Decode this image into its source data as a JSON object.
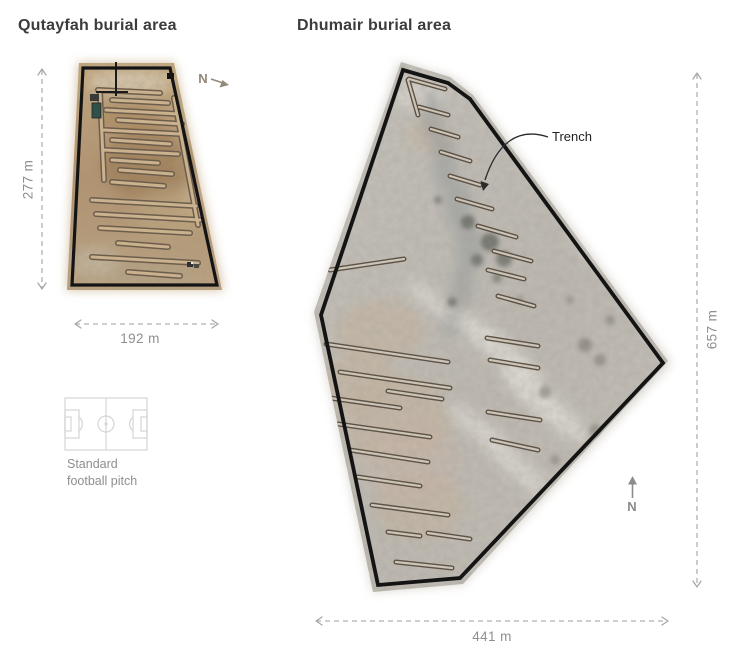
{
  "figures": {
    "qutayfah": {
      "title": "Qutayfah burial area",
      "height_label": "277 m",
      "width_label": "192 m",
      "north_label": "N"
    },
    "dhumair": {
      "title": "Dhumair burial area",
      "height_label": "657 m",
      "width_label": "441 m",
      "north_label": "N",
      "annotation": "Trench"
    }
  },
  "legend": {
    "line1": "Standard",
    "line2": "football pitch"
  },
  "colors": {
    "title_text": "#3c3c3c",
    "dimension_text": "#8f8f8f",
    "dimension_line": "#b0b0b0",
    "boundary_outline": "#141414",
    "left_terrain": "#b79a72",
    "right_terrain": "#c2bfb7",
    "trench_outline": "#5d5246"
  }
}
